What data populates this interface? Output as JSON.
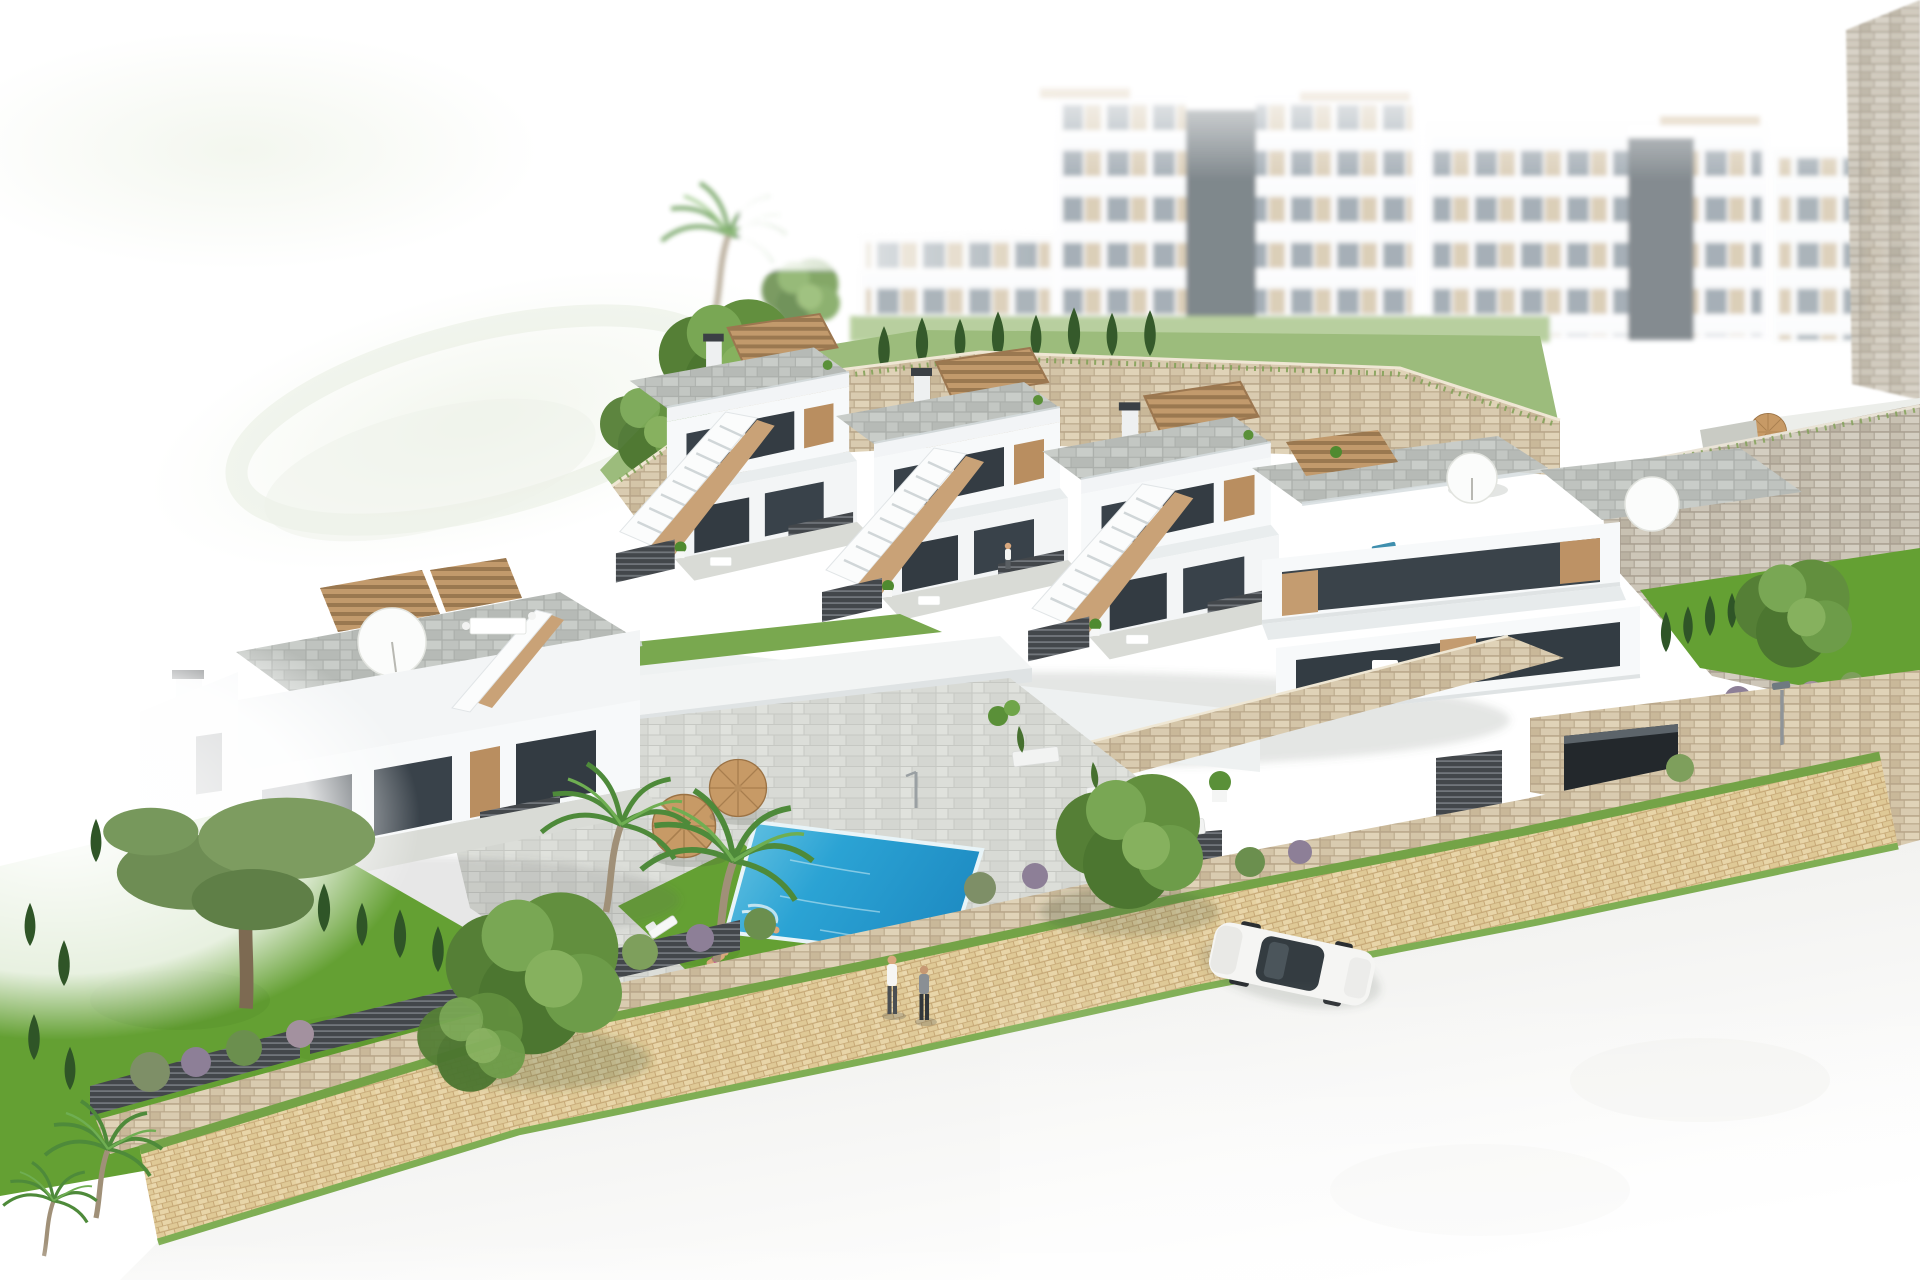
{
  "meta": {
    "title": "Aerial 3D architectural rendering of a hillside residential development",
    "description": "Photorealistic aerial render: a row of white terraced townhouses with roof terraces, wooden pergolas and exterior stairs, a communal swimming pool with sun loungers and two wicker parasols, stone retaining walls, gardens with palms and cypress hedges, a paved promenade with two pedestrians, a road with a white sedan, a driveway with a silver car, and faded white apartment blocks with a second pool in the background."
  },
  "colors": {
    "facade": "#f7f9fa",
    "facadeShade": "#e4e8ea",
    "glassDark": "#333c43",
    "glassMid": "#8e9aa3",
    "wood": "#c29a6c",
    "woodDark": "#a37e50",
    "slatDark": "#45494d",
    "deckGray": "#bcc0bc",
    "stoneBeige": "#d8cab0",
    "stoneGray": "#c6bfb0",
    "paver": "#e4d1a4",
    "roadLight": "#ebebe9",
    "lawn": "#64a033",
    "grassBand": "#9cbc7c",
    "hedgeDark": "#2f5527",
    "treeGreen": "#5d8f3f",
    "poolWater": "#2ba3d4",
    "poolLight": "#7fd0e8",
    "poolDeep": "#1b86bf",
    "bgPool": "#4fb2dc",
    "carWhite": "#f5f5f3",
    "carSilver": "#b9b5b3",
    "skin": "#d9a87e",
    "tileLight": "#dadbd7"
  },
  "scene": {
    "type": "architectural visualization (no UI text present)",
    "background": {
      "apartment_blocks": 4,
      "elevator_towers": 2,
      "community_pool": 1,
      "background_parasols": 1,
      "rendered_blurred": true
    },
    "midground": {
      "townhouse_row_units": 4,
      "corner_residence_with_balconies": 1,
      "left_townhouse_block_units": 2,
      "roof_terraces_with_pergolas": 6,
      "exterior_staircases": 5,
      "stone_retaining_walls": 4,
      "garage_entrances": 1
    },
    "foreground": {
      "communal_pool": 1,
      "pool_parasols": 2,
      "sun_loungers": 10,
      "people_total": 4,
      "pedestrians_on_promenade": 2,
      "person_on_stairs": 1,
      "person_in_pool": 1,
      "cars": 2,
      "palm_trees": 5,
      "cypress_hedge": true,
      "lawn_garden": true,
      "paved_promenade": true,
      "road": true,
      "street_lamps": 2
    }
  }
}
